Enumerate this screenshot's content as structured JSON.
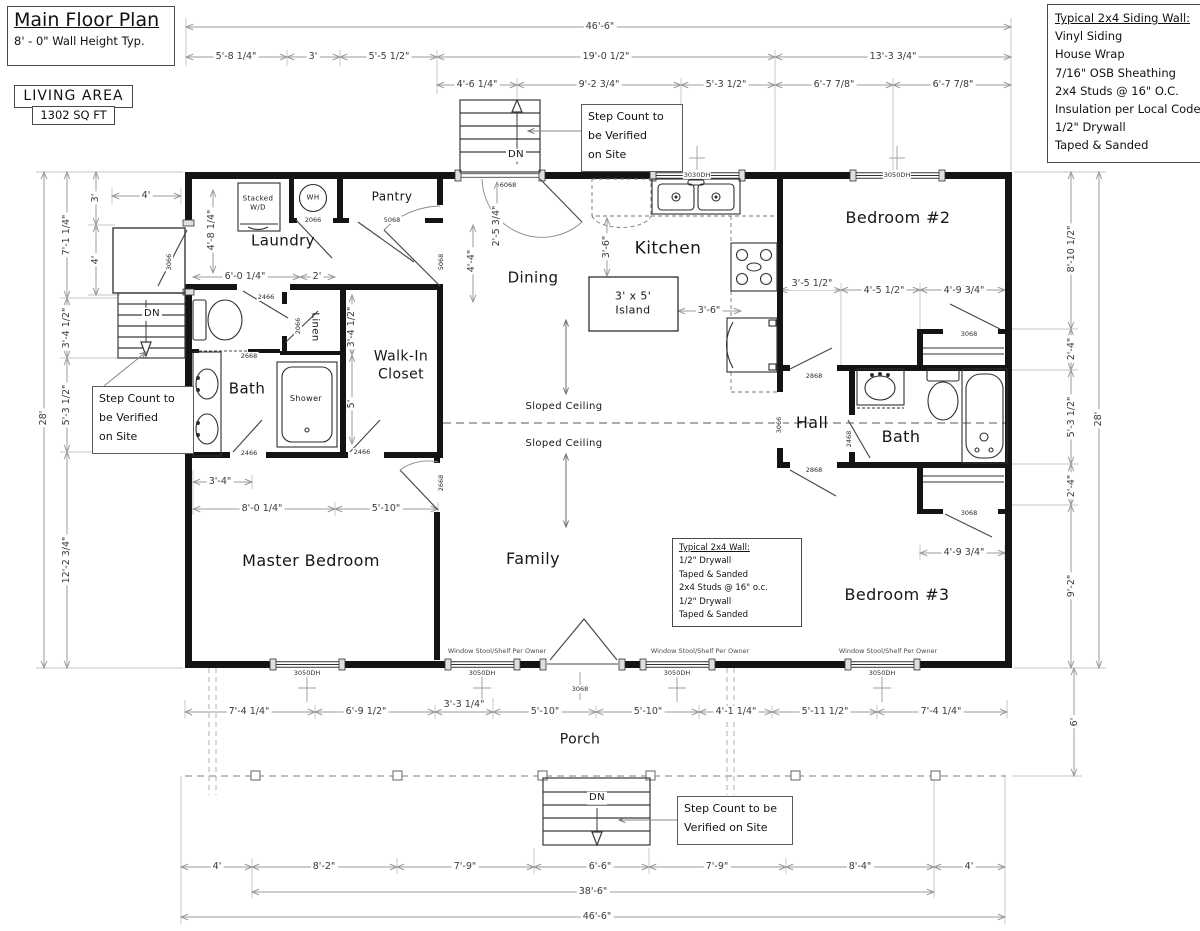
{
  "title_block": {
    "title": "Main Floor Plan",
    "subtitle": "8' - 0\" Wall Height Typ."
  },
  "living_area": {
    "label": "LIVING AREA",
    "value": "1302 SQ FT"
  },
  "siding_note": {
    "title": "Typical 2x4 Siding Wall:",
    "lines": [
      "Vinyl Siding",
      "House Wrap",
      "7/16\" OSB Sheathing",
      "2x4 Studs @ 16\" O.C.",
      "Insulation per Local Code",
      "1/2\" Drywall",
      "Taped & Sanded"
    ]
  },
  "wall_note": {
    "title": "Typical 2x4 Wall:",
    "lines": [
      "1/2\" Drywall",
      "Taped & Sanded",
      "2x4 Studs @ 16\" o.c.",
      "1/2\" Drywall",
      "Taped & Sanded"
    ]
  },
  "step_notes": {
    "top": "Step Count to\nbe Verified\non Site",
    "left": "Step Count to\nbe Verified\non Site",
    "bottom": "Step Count to be\nVerified on Site"
  },
  "colors": {
    "wall": "#141414",
    "dim_line": "#9b9b9b",
    "ext_line": "#c4c4c4",
    "fixture": "#2e2e2e"
  },
  "rooms": [
    {
      "id": "laundry",
      "text": "Laundry",
      "x": 283,
      "y": 241,
      "fs": 15
    },
    {
      "id": "pantry",
      "text": "Pantry",
      "x": 392,
      "y": 197,
      "fs": 12
    },
    {
      "id": "kitchen",
      "text": "Kitchen",
      "x": 668,
      "y": 249,
      "fs": 17
    },
    {
      "id": "dining",
      "text": "Dining",
      "x": 533,
      "y": 278,
      "fs": 15
    },
    {
      "id": "bedroom-2",
      "text": "Bedroom #2",
      "x": 898,
      "y": 218,
      "fs": 16
    },
    {
      "id": "hall",
      "text": "Hall",
      "x": 812,
      "y": 423,
      "fs": 16
    },
    {
      "id": "bath-right",
      "text": "Bath",
      "x": 901,
      "y": 437,
      "fs": 16
    },
    {
      "id": "bath-left",
      "text": "Bath",
      "x": 247,
      "y": 389,
      "fs": 15
    },
    {
      "id": "shower",
      "text": "Shower",
      "x": 306,
      "y": 399,
      "fs": 8
    },
    {
      "id": "linen",
      "text": "Linen",
      "x": 314,
      "y": 327,
      "fs": 10,
      "rot": 1
    },
    {
      "id": "walk-in-closet",
      "text": "Walk-In\nCloset",
      "x": 401,
      "y": 366,
      "fs": 14
    },
    {
      "id": "master-bedroom",
      "text": "Master Bedroom",
      "x": 311,
      "y": 561,
      "fs": 16
    },
    {
      "id": "family",
      "text": "Family",
      "x": 533,
      "y": 559,
      "fs": 16
    },
    {
      "id": "bedroom-3",
      "text": "Bedroom #3",
      "x": 897,
      "y": 595,
      "fs": 16
    },
    {
      "id": "porch",
      "text": "Porch",
      "x": 580,
      "y": 740,
      "fs": 14
    },
    {
      "id": "island",
      "text": "3' x 5'\nIsland",
      "x": 633,
      "y": 303,
      "fs": 11
    },
    {
      "id": "stacked-wd",
      "text": "Stacked\nW/D",
      "x": 258,
      "y": 203,
      "fs": 7
    },
    {
      "id": "water-heater",
      "text": "WH",
      "x": 313,
      "y": 198,
      "fs": 7
    },
    {
      "id": "sloped-ceiling-1",
      "text": "Sloped Ceiling",
      "x": 564,
      "y": 407,
      "fs": 10
    },
    {
      "id": "sloped-ceiling-2",
      "text": "Sloped Ceiling",
      "x": 564,
      "y": 444,
      "fs": 10
    },
    {
      "id": "dn-top",
      "text": "DN",
      "x": 516,
      "y": 155,
      "fs": 10,
      "bg": 1
    },
    {
      "id": "dn-left",
      "text": "DN",
      "x": 152,
      "y": 314,
      "fs": 10,
      "bg": 1
    },
    {
      "id": "dn-porch",
      "text": "DN",
      "x": 597,
      "y": 798,
      "fs": 10,
      "bg": 1
    }
  ],
  "dims": [
    {
      "text": "46'-6\"",
      "x": 600,
      "y": 27
    },
    {
      "text": "5'-8 1/4\"",
      "x": 236,
      "y": 57
    },
    {
      "text": "3'",
      "x": 313,
      "y": 57
    },
    {
      "text": "5'-5 1/2\"",
      "x": 389,
      "y": 57
    },
    {
      "text": "19'-0 1/2\"",
      "x": 606,
      "y": 57
    },
    {
      "text": "13'-3 3/4\"",
      "x": 893,
      "y": 57
    },
    {
      "text": "4'-6 1/4\"",
      "x": 477,
      "y": 85
    },
    {
      "text": "9'-2 3/4\"",
      "x": 599,
      "y": 85
    },
    {
      "text": "5'-3 1/2\"",
      "x": 726,
      "y": 85
    },
    {
      "text": "6'-7 7/8\"",
      "x": 834,
      "y": 85
    },
    {
      "text": "6'-7 7/8\"",
      "x": 953,
      "y": 85
    },
    {
      "text": "28'",
      "x": 44,
      "y": 418,
      "rot": 1
    },
    {
      "text": "7'-1 1/4\"",
      "x": 67,
      "y": 235,
      "rot": 1
    },
    {
      "text": "3'-4 1/2\"",
      "x": 67,
      "y": 328,
      "rot": 1
    },
    {
      "text": "5'-3 1/2\"",
      "x": 67,
      "y": 405,
      "rot": 1
    },
    {
      "text": "12'-2 3/4\"",
      "x": 67,
      "y": 560,
      "rot": 1
    },
    {
      "text": "3'",
      "x": 96,
      "y": 198,
      "rot": 1
    },
    {
      "text": "4'",
      "x": 146,
      "y": 196
    },
    {
      "text": "4'",
      "x": 96,
      "y": 260,
      "rot": 1
    },
    {
      "text": "2'-5 3/4\"",
      "x": 497,
      "y": 226,
      "rot": 1
    },
    {
      "text": "4'-4\"",
      "x": 472,
      "y": 261,
      "rot": 1
    },
    {
      "text": "3'-6\"",
      "x": 607,
      "y": 247,
      "rot": 1
    },
    {
      "text": "3'-6\"",
      "x": 709,
      "y": 311
    },
    {
      "text": "4'-8 1/4\"",
      "x": 212,
      "y": 230,
      "rot": 1
    },
    {
      "text": "6'-0 1/4\"",
      "x": 245,
      "y": 277
    },
    {
      "text": "2'",
      "x": 317,
      "y": 277
    },
    {
      "text": "3'-4 1/2\"",
      "x": 352,
      "y": 327,
      "rot": 1
    },
    {
      "text": "5'",
      "x": 352,
      "y": 404,
      "rot": 1
    },
    {
      "text": "3'-5 1/2\"",
      "x": 812,
      "y": 284
    },
    {
      "text": "4'-5 1/2\"",
      "x": 884,
      "y": 291
    },
    {
      "text": "4'-9 3/4\"",
      "x": 964,
      "y": 291
    },
    {
      "text": "4'-9 3/4\"",
      "x": 964,
      "y": 553
    },
    {
      "text": "3'-4\"",
      "x": 220,
      "y": 482
    },
    {
      "text": "8'-0 1/4\"",
      "x": 262,
      "y": 509
    },
    {
      "text": "5'-10\"",
      "x": 386,
      "y": 509
    },
    {
      "text": "8'-10 1/2\"",
      "x": 1072,
      "y": 249,
      "rot": 1
    },
    {
      "text": "2'-4\"",
      "x": 1072,
      "y": 349,
      "rot": 1
    },
    {
      "text": "5'-3 1/2\"",
      "x": 1072,
      "y": 417,
      "rot": 1
    },
    {
      "text": "2'-4\"",
      "x": 1072,
      "y": 486,
      "rot": 1
    },
    {
      "text": "9'-2\"",
      "x": 1072,
      "y": 586,
      "rot": 1
    },
    {
      "text": "28'",
      "x": 1099,
      "y": 419,
      "rot": 1
    },
    {
      "text": "6'",
      "x": 1075,
      "y": 722,
      "rot": 1
    },
    {
      "text": "7'-4 1/4\"",
      "x": 249,
      "y": 712
    },
    {
      "text": "6'-9 1/2\"",
      "x": 366,
      "y": 712
    },
    {
      "text": "3'-3 1/4\"",
      "x": 464,
      "y": 705
    },
    {
      "text": "5'-10\"",
      "x": 545,
      "y": 712
    },
    {
      "text": "5'-10\"",
      "x": 648,
      "y": 712
    },
    {
      "text": "4'-1 1/4\"",
      "x": 736,
      "y": 712
    },
    {
      "text": "5'-11 1/2\"",
      "x": 825,
      "y": 712
    },
    {
      "text": "7'-4 1/4\"",
      "x": 941,
      "y": 712
    },
    {
      "text": "4'",
      "x": 217,
      "y": 867
    },
    {
      "text": "8'-2\"",
      "x": 324,
      "y": 867
    },
    {
      "text": "7'-9\"",
      "x": 465,
      "y": 867
    },
    {
      "text": "6'-6\"",
      "x": 600,
      "y": 867
    },
    {
      "text": "7'-9\"",
      "x": 717,
      "y": 867
    },
    {
      "text": "8'-4\"",
      "x": 860,
      "y": 867
    },
    {
      "text": "4'",
      "x": 969,
      "y": 867
    },
    {
      "text": "38'-6\"",
      "x": 593,
      "y": 892
    },
    {
      "text": "46'-6\"",
      "x": 597,
      "y": 917
    }
  ],
  "tags": [
    {
      "text": "6068",
      "x": 508,
      "y": 185
    },
    {
      "text": "3030DH",
      "x": 697,
      "y": 175
    },
    {
      "text": "3050DH",
      "x": 897,
      "y": 175
    },
    {
      "text": "3066",
      "x": 169,
      "y": 262,
      "rot": 1
    },
    {
      "text": "2066",
      "x": 313,
      "y": 220
    },
    {
      "text": "5068",
      "x": 392,
      "y": 220
    },
    {
      "text": "5068",
      "x": 441,
      "y": 262,
      "rot": 1
    },
    {
      "text": "2466",
      "x": 266,
      "y": 297
    },
    {
      "text": "2066",
      "x": 298,
      "y": 326,
      "rot": 1
    },
    {
      "text": "2668",
      "x": 249,
      "y": 356
    },
    {
      "text": "2466",
      "x": 249,
      "y": 453
    },
    {
      "text": "2466",
      "x": 362,
      "y": 452
    },
    {
      "text": "2668",
      "x": 441,
      "y": 483,
      "rot": 1
    },
    {
      "text": "2868",
      "x": 814,
      "y": 376
    },
    {
      "text": "3068",
      "x": 969,
      "y": 334
    },
    {
      "text": "2468",
      "x": 849,
      "y": 439,
      "rot": 1
    },
    {
      "text": "2868",
      "x": 814,
      "y": 470
    },
    {
      "text": "3068",
      "x": 969,
      "y": 513
    },
    {
      "text": "3066",
      "x": 779,
      "y": 425,
      "rot": 1
    },
    {
      "text": "3068",
      "x": 580,
      "y": 689
    },
    {
      "text": "3050DH",
      "x": 307,
      "y": 673
    },
    {
      "text": "3050DH",
      "x": 482,
      "y": 673
    },
    {
      "text": "3050DH",
      "x": 677,
      "y": 673
    },
    {
      "text": "3050DH",
      "x": 882,
      "y": 673
    }
  ],
  "stool_notes": [
    {
      "text": "Window Stool/Shelf Per Owner",
      "x": 497,
      "y": 651
    },
    {
      "text": "Window Stool/Shelf Per Owner",
      "x": 700,
      "y": 651
    },
    {
      "text": "Window Stool/Shelf Per Owner",
      "x": 888,
      "y": 651
    }
  ]
}
